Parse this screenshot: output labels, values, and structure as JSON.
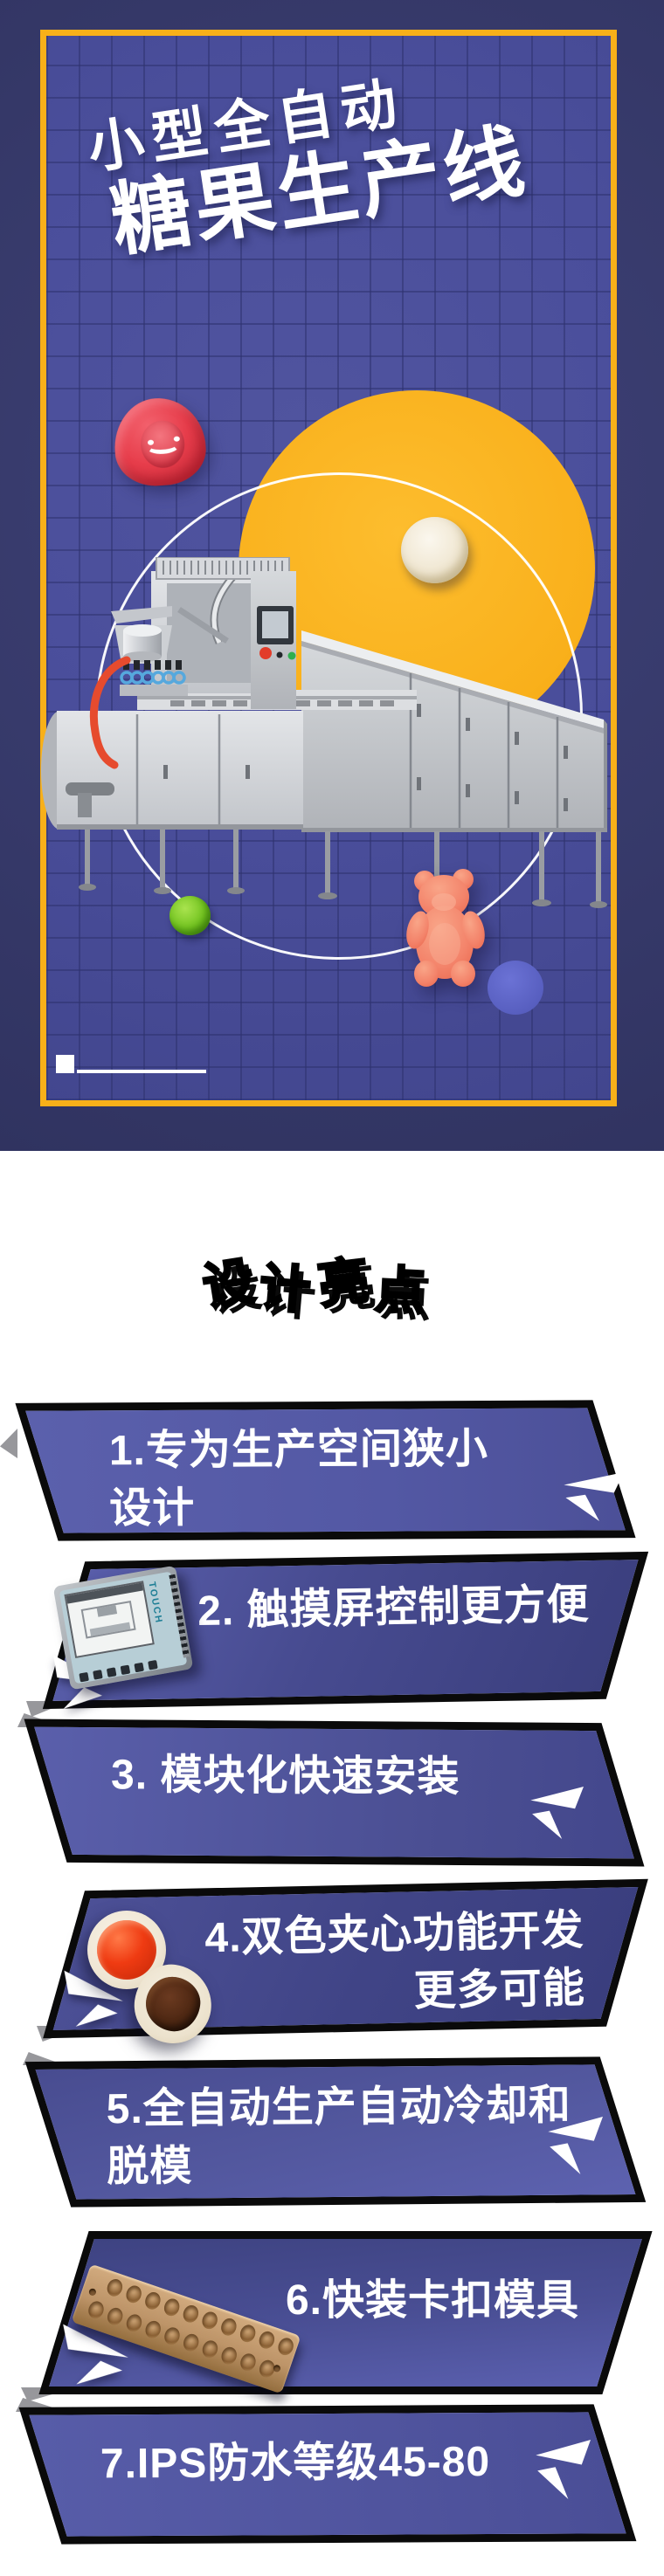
{
  "hero": {
    "title_line1": "小型全自动",
    "title_line2": "糖果生产线",
    "decorations": [
      "red-gummy-candy",
      "cream-round-candy",
      "green-gummy-ball",
      "orange-gummy-bear",
      "yellow-circle",
      "white-ring",
      "candy-machine-photo"
    ]
  },
  "design_section": {
    "heading": "设计亮点",
    "highlights": [
      {
        "lines": [
          "1.专为生产空间狭小",
          "设计"
        ]
      },
      {
        "lines": [
          "2. 触摸屏控制更方便"
        ],
        "panel_label": "TOUCH"
      },
      {
        "lines": [
          "3. 模块化快速安装"
        ]
      },
      {
        "lines": [
          "4.双色夹心功能开发",
          "更多可能"
        ]
      },
      {
        "lines": [
          "5.全自动生产自动冷却和",
          "脱模"
        ]
      },
      {
        "lines": [
          "6.快装卡扣模具"
        ]
      },
      {
        "lines": [
          "7.IPS防水等级45-80"
        ]
      }
    ]
  },
  "palette": {
    "outer_navy": "#373a6b",
    "panel_blue": "#4a4e9b",
    "grid_line": "#42468e",
    "accent_yellow": "#f8b019",
    "banner_blue": "#575ca8",
    "banner_blue_dark": "#3e4383",
    "border_black": "#0a0a0a",
    "text_white": "#ffffff",
    "gummy_red": "#e73d4b",
    "gummy_orange": "#f28a6d",
    "gummy_green": "#72c31f",
    "mold_bronze": "#bd9468",
    "touch_teal": "#b7ced6"
  }
}
